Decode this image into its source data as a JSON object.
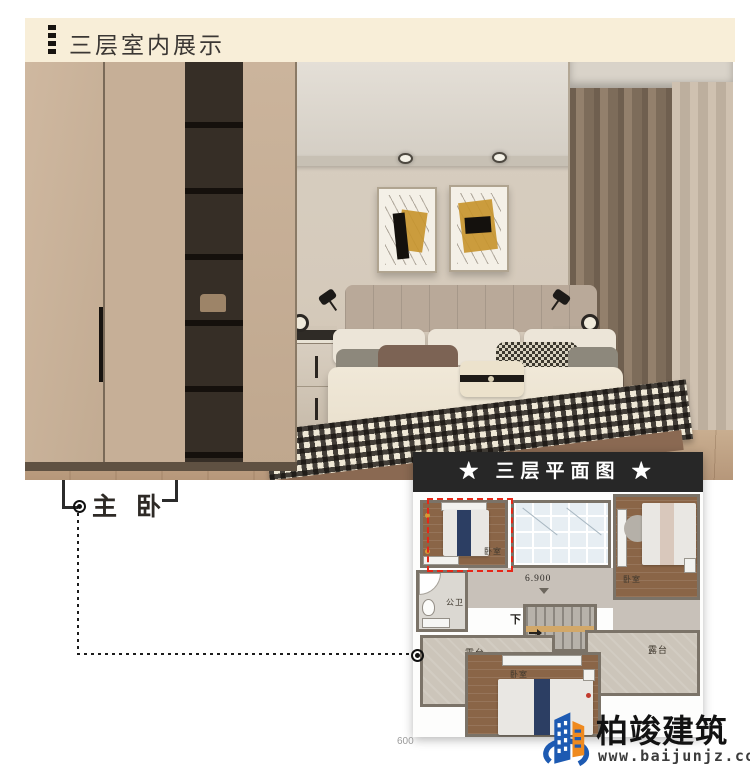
{
  "header": {
    "title": "三层室内展示"
  },
  "photo": {
    "label": "主 卧"
  },
  "plan": {
    "title": "★ 三层平面图 ★",
    "bedroom": "卧室",
    "bathroom": "公卫",
    "terrace": "露台",
    "elevation": "6.900",
    "stairs": "下",
    "partial_dim": "600"
  },
  "logo": {
    "name": "柏竣建筑",
    "url": "www.baijunjz.com"
  },
  "colors": {
    "header_bg": "#f8eed8",
    "plan_title_bg": "#272727",
    "highlight_red": "#e62617",
    "logo_blue": "#1d5ab2",
    "logo_orange": "#ef8a1f"
  }
}
